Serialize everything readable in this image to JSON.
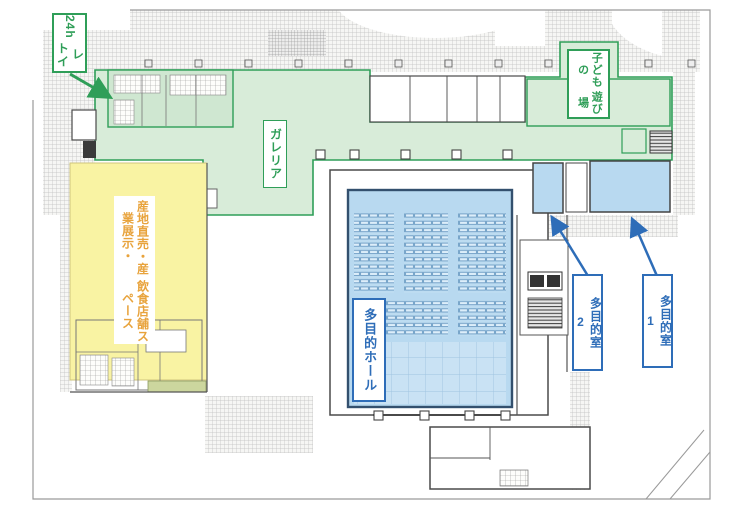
{
  "colors": {
    "zone_green_fill": "#d8ecd9",
    "zone_green_border": "#2f9e58",
    "zone_yellow_fill": "#f9f3a3",
    "zone_blue_fill": "#b8d9f0",
    "label_green": "#2f9e58",
    "label_blue": "#2e6db8",
    "label_orange": "#e8a33c",
    "wall_gray": "#4a4a4a"
  },
  "annotations": {
    "toilet_24h": {
      "line1": "24h",
      "line2": "トイレ"
    },
    "play_area": {
      "line1": "子どもの",
      "line2": "遊び場"
    },
    "galleria": {
      "text": "ガレリア"
    },
    "market_space": {
      "line1": "産地直売・産業展示・",
      "line2": "飲食店舗スペース"
    },
    "multipurpose_hall": {
      "text": "多目的ホール"
    },
    "multipurpose_room2": {
      "text": "多目的室",
      "num": "2"
    },
    "multipurpose_room1": {
      "text": "多目的室",
      "num": "1"
    }
  }
}
